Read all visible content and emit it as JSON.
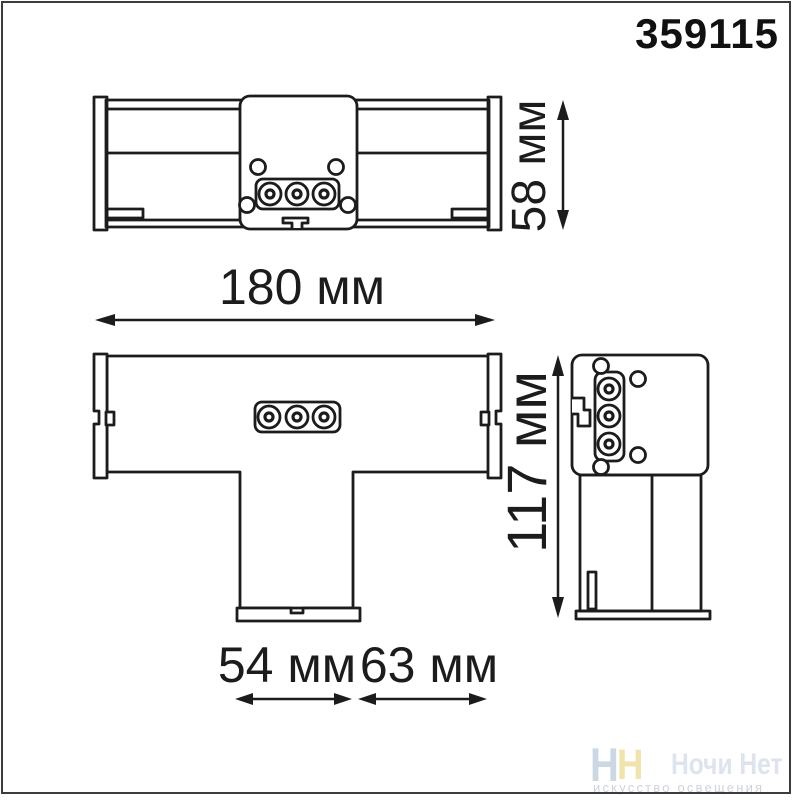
{
  "article": "359115",
  "dimensions": {
    "front_height": "58 мм",
    "width": "180 мм",
    "depth": "117 мм",
    "stem_width": "54 мм",
    "stem_offset": "63 мм"
  },
  "drawing": {
    "line_color": "#1c1c1c"
  },
  "watermark": {
    "logo_letters": [
      "Н",
      "Н"
    ],
    "logo_color_blue": "#ccd7e4",
    "logo_color_yellow": "#f0e4ac",
    "brand": "Ночи Нет",
    "brand_color": "#dde4ee",
    "tagline": "искусство освещения",
    "tagline_color": "#ced4dd"
  }
}
